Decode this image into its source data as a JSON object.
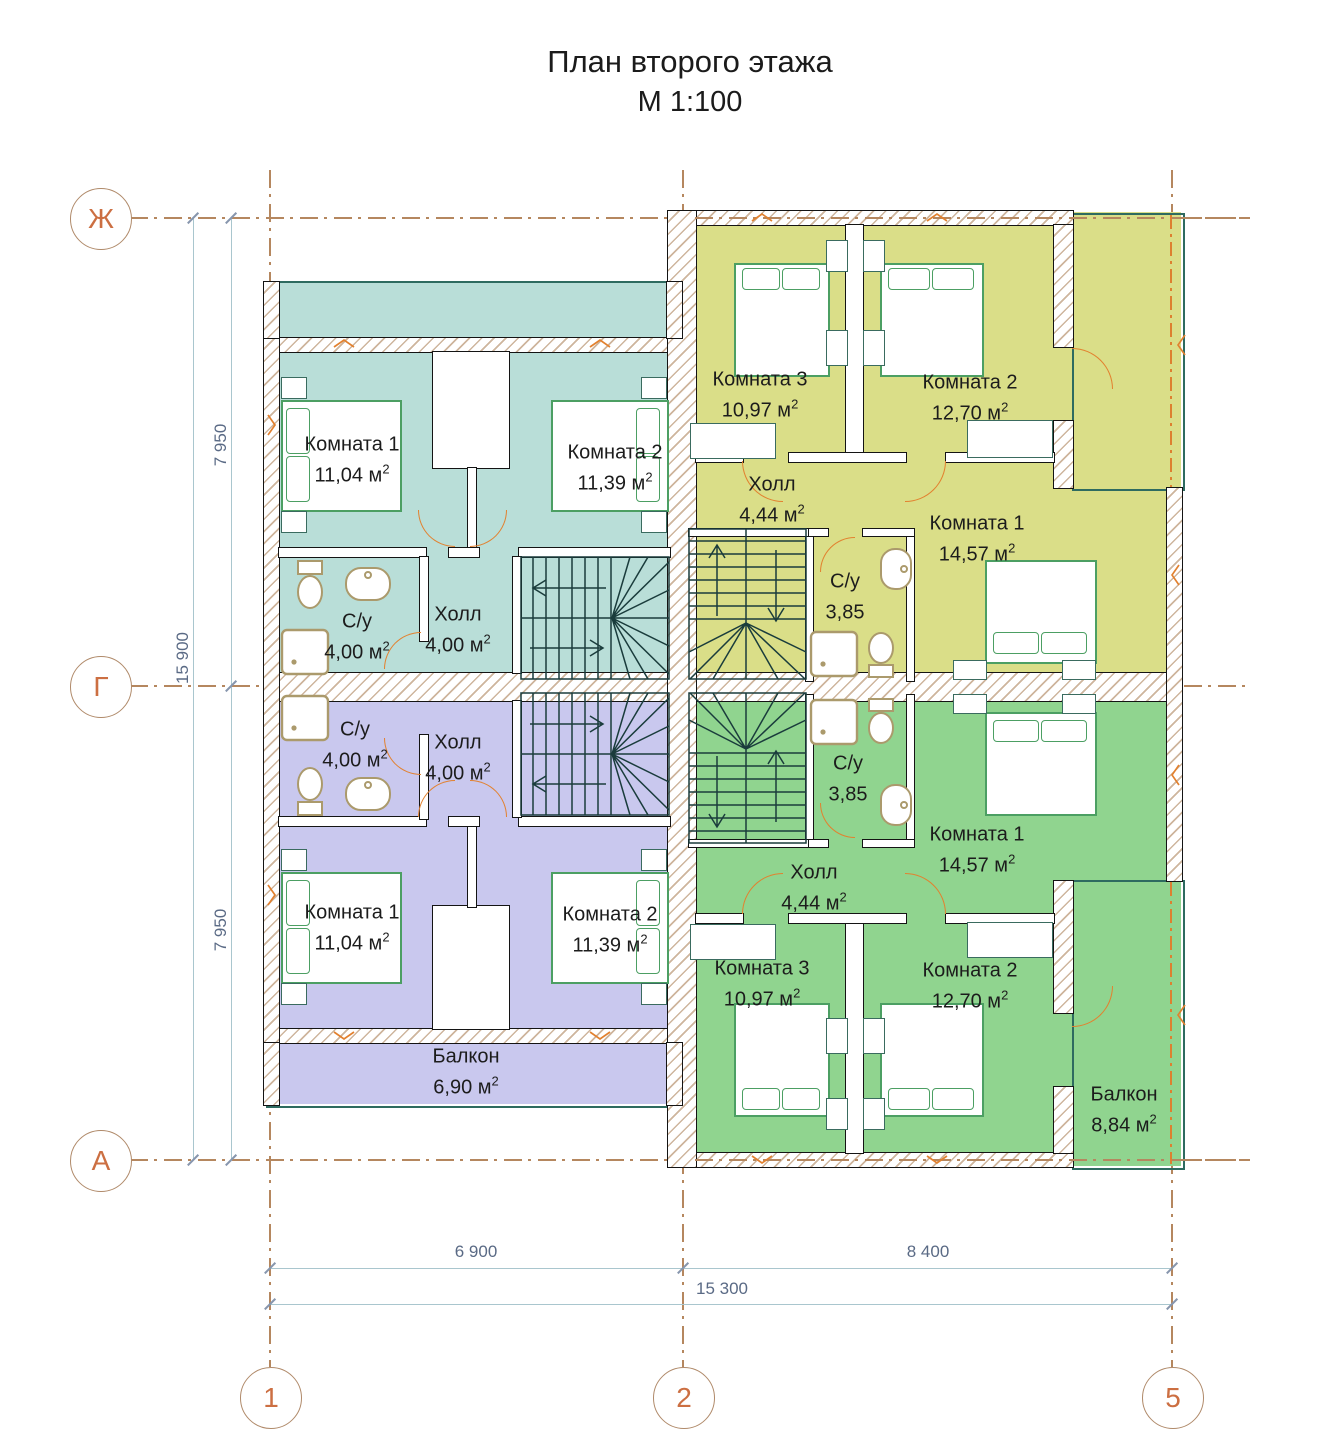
{
  "title": {
    "line1": "План второго этажа",
    "line2": "М 1:100"
  },
  "axes": {
    "rows": [
      {
        "label": "Ж"
      },
      {
        "label": "Г"
      },
      {
        "label": "А"
      }
    ],
    "cols": [
      {
        "label": "1"
      },
      {
        "label": "2"
      },
      {
        "label": "5"
      }
    ]
  },
  "dims": {
    "left_top": "7 950",
    "left_bottom": "7 950",
    "left_total": "15 900",
    "bottom_left": "6 900",
    "bottom_right": "8 400",
    "bottom_total": "15 300"
  },
  "colors": {
    "teal": "#b9ded8",
    "lavender": "#c9c8ee",
    "olive": "#dade88",
    "green": "#90d48f",
    "axis_orange": "#cc6f42",
    "grid_brown": "#b5875f",
    "dim_blue": "#a9c6ce",
    "dim_text": "#5a6a85",
    "bed_green": "#4c9f63",
    "fixture_tan": "#ab9a6c",
    "door_orange": "#e2812f",
    "stair_dark": "#1a3c3c",
    "balcony_edge": "#2e6b60"
  },
  "rooms": {
    "tl_k1": {
      "name": "Комната 1",
      "area": "11,04 м",
      "sup": "2"
    },
    "tl_k2": {
      "name": "Комната 2",
      "area": "11,39 м",
      "sup": "2"
    },
    "tl_su": {
      "name": "С/у",
      "area": "4,00 м",
      "sup": "2"
    },
    "tl_hall": {
      "name": "Холл",
      "area": "4,00 м",
      "sup": "2"
    },
    "tr_k3": {
      "name": "Комната 3",
      "area": "10,97 м",
      "sup": "2"
    },
    "tr_k2": {
      "name": "Комната 2",
      "area": "12,70 м",
      "sup": "2"
    },
    "tr_hall": {
      "name": "Холл",
      "area": "4,44 м",
      "sup": "2"
    },
    "tr_su": {
      "name": "С/у",
      "area": "3,85",
      "sup": ""
    },
    "tr_k1": {
      "name": "Комната 1",
      "area": "14,57 м",
      "sup": "2"
    },
    "bl_su": {
      "name": "С/у",
      "area": "4,00 м",
      "sup": "2"
    },
    "bl_hall": {
      "name": "Холл",
      "area": "4,00 м",
      "sup": "2"
    },
    "bl_k1": {
      "name": "Комната 1",
      "area": "11,04 м",
      "sup": "2"
    },
    "bl_k2": {
      "name": "Комната 2",
      "area": "11,39 м",
      "sup": "2"
    },
    "bl_balcony": {
      "name": "Балкон",
      "area": "6,90 м",
      "sup": "2"
    },
    "br_su": {
      "name": "С/у",
      "area": "3,85",
      "sup": ""
    },
    "br_hall": {
      "name": "Холл",
      "area": "4,44 м",
      "sup": "2"
    },
    "br_k1": {
      "name": "Комната 1",
      "area": "14,57 м",
      "sup": "2"
    },
    "br_k3": {
      "name": "Комната 3",
      "area": "10,97 м",
      "sup": "2"
    },
    "br_k2": {
      "name": "Комната 2",
      "area": "12,70 м",
      "sup": "2"
    },
    "br_balcony": {
      "name": "Балкон",
      "area": "8,84 м",
      "sup": "2"
    }
  }
}
